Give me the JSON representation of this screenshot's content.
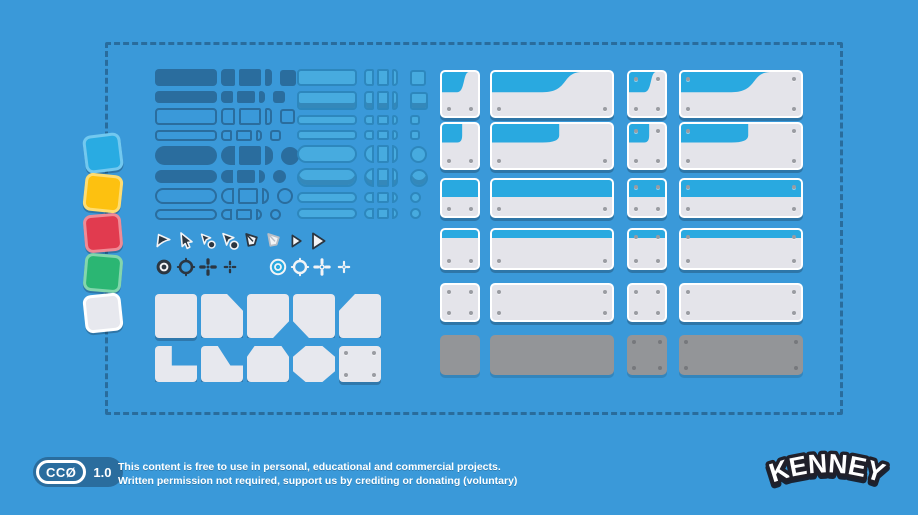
{
  "window": {
    "width": 918,
    "height": 515,
    "background": "#3a99d9"
  },
  "palette": {
    "background": "#3a99d9",
    "dark_blue": "#2a6d9e",
    "light_button_fill": "#47abdf",
    "light_button_border": "#2d87bd",
    "panel_header_blue": "#29a9e0",
    "panel_body": "#e4e4ea",
    "panel_gray": "#939598",
    "icon_dark": "#2b3641",
    "icon_white": "#f3f4f6"
  },
  "sample_squares": [
    {
      "name": "blue",
      "fill": "#29abe2",
      "border": "#72c8ef"
    },
    {
      "name": "yellow",
      "fill": "#fdc110",
      "border": "#fedd72"
    },
    {
      "name": "red",
      "fill": "#e13b4f",
      "border": "#ef8b96"
    },
    {
      "name": "green",
      "fill": "#2bb673",
      "border": "#83d6ac"
    },
    {
      "name": "white",
      "fill": "#e7e8ee",
      "border": "#ffffff"
    }
  ],
  "dark_buttons": {
    "color": "#2a6d9e",
    "rows": [
      {
        "shape": "rect",
        "variant": "filled",
        "size": "large"
      },
      {
        "shape": "rect",
        "variant": "filled",
        "size": "small"
      },
      {
        "shape": "rect",
        "variant": "outline",
        "size": "large"
      },
      {
        "shape": "rect",
        "variant": "outline",
        "size": "small"
      },
      {
        "shape": "pill",
        "variant": "filled",
        "size": "large"
      },
      {
        "shape": "pill",
        "variant": "filled",
        "size": "small"
      },
      {
        "shape": "pill",
        "variant": "outline",
        "size": "large"
      },
      {
        "shape": "pill",
        "variant": "outline",
        "size": "small"
      }
    ]
  },
  "light_buttons": {
    "fill": "#47abdf",
    "border": "#2d87bd",
    "rows": [
      {
        "shape": "rect",
        "variant": "flat",
        "size": "large"
      },
      {
        "shape": "rect",
        "variant": "raised",
        "size": "large"
      },
      {
        "shape": "rect",
        "variant": "flat",
        "size": "thin"
      },
      {
        "shape": "rect",
        "variant": "flat",
        "size": "thin"
      },
      {
        "shape": "pill",
        "variant": "flat",
        "size": "large"
      },
      {
        "shape": "pill",
        "variant": "raised",
        "size": "large"
      },
      {
        "shape": "pill",
        "variant": "flat",
        "size": "thin"
      },
      {
        "shape": "pill",
        "variant": "flat",
        "size": "thin"
      }
    ]
  },
  "cursors": [
    "cursor-arrow-flat",
    "cursor-arrow-classic",
    "cursor-arrow-busy-small",
    "cursor-arrow-busy",
    "cursor-kite-dark",
    "cursor-kite-light",
    "cursor-arrowhead-small",
    "cursor-arrowhead-large"
  ],
  "crosshairs": [
    "crosshair-target-filled-dark",
    "crosshair-ring-dark",
    "crosshair-plus-dark",
    "crosshair-plus-dark-small",
    "crosshair-target-blue",
    "crosshair-ring-white",
    "crosshair-plus-white",
    "crosshair-plus-white-small"
  ],
  "keys": {
    "rows": [
      [
        "square",
        "bevel-tr",
        "bevel-br",
        "bevel-bl",
        "bevel-tl"
      ],
      [
        "l-shape",
        "l-slope",
        "trapezoid-top",
        "octagon",
        "square-screws"
      ]
    ]
  },
  "panels": {
    "columns": [
      {
        "size": "small"
      },
      {
        "size": "wide"
      },
      {
        "size": "small"
      },
      {
        "size": "wide"
      }
    ],
    "rows": [
      {
        "type": "header-swoosh",
        "screws": [
          "bottom",
          "bottom",
          "all",
          "all"
        ]
      },
      {
        "type": "header-tab",
        "screws": [
          "bottom",
          "bottom",
          "all",
          "all"
        ]
      },
      {
        "type": "header-flat",
        "screws": [
          "bottom",
          "bottom",
          "all",
          "all"
        ]
      },
      {
        "type": "header-strip",
        "screws": [
          "bottom",
          "bottom",
          "all",
          "all"
        ]
      },
      {
        "type": "plain",
        "screws": [
          "all",
          "all",
          "all",
          "all"
        ]
      },
      {
        "type": "gray",
        "screws": [
          "none",
          "none",
          "all",
          "all"
        ]
      }
    ]
  },
  "footer": {
    "badge_label": "CCØ",
    "badge_version": "1.0",
    "line1": "This content is free to use in personal, educational and commercial projects.",
    "line2": "Written permission not required, support us by crediting or donating (voluntary)"
  },
  "logo_text": "KENNEY"
}
